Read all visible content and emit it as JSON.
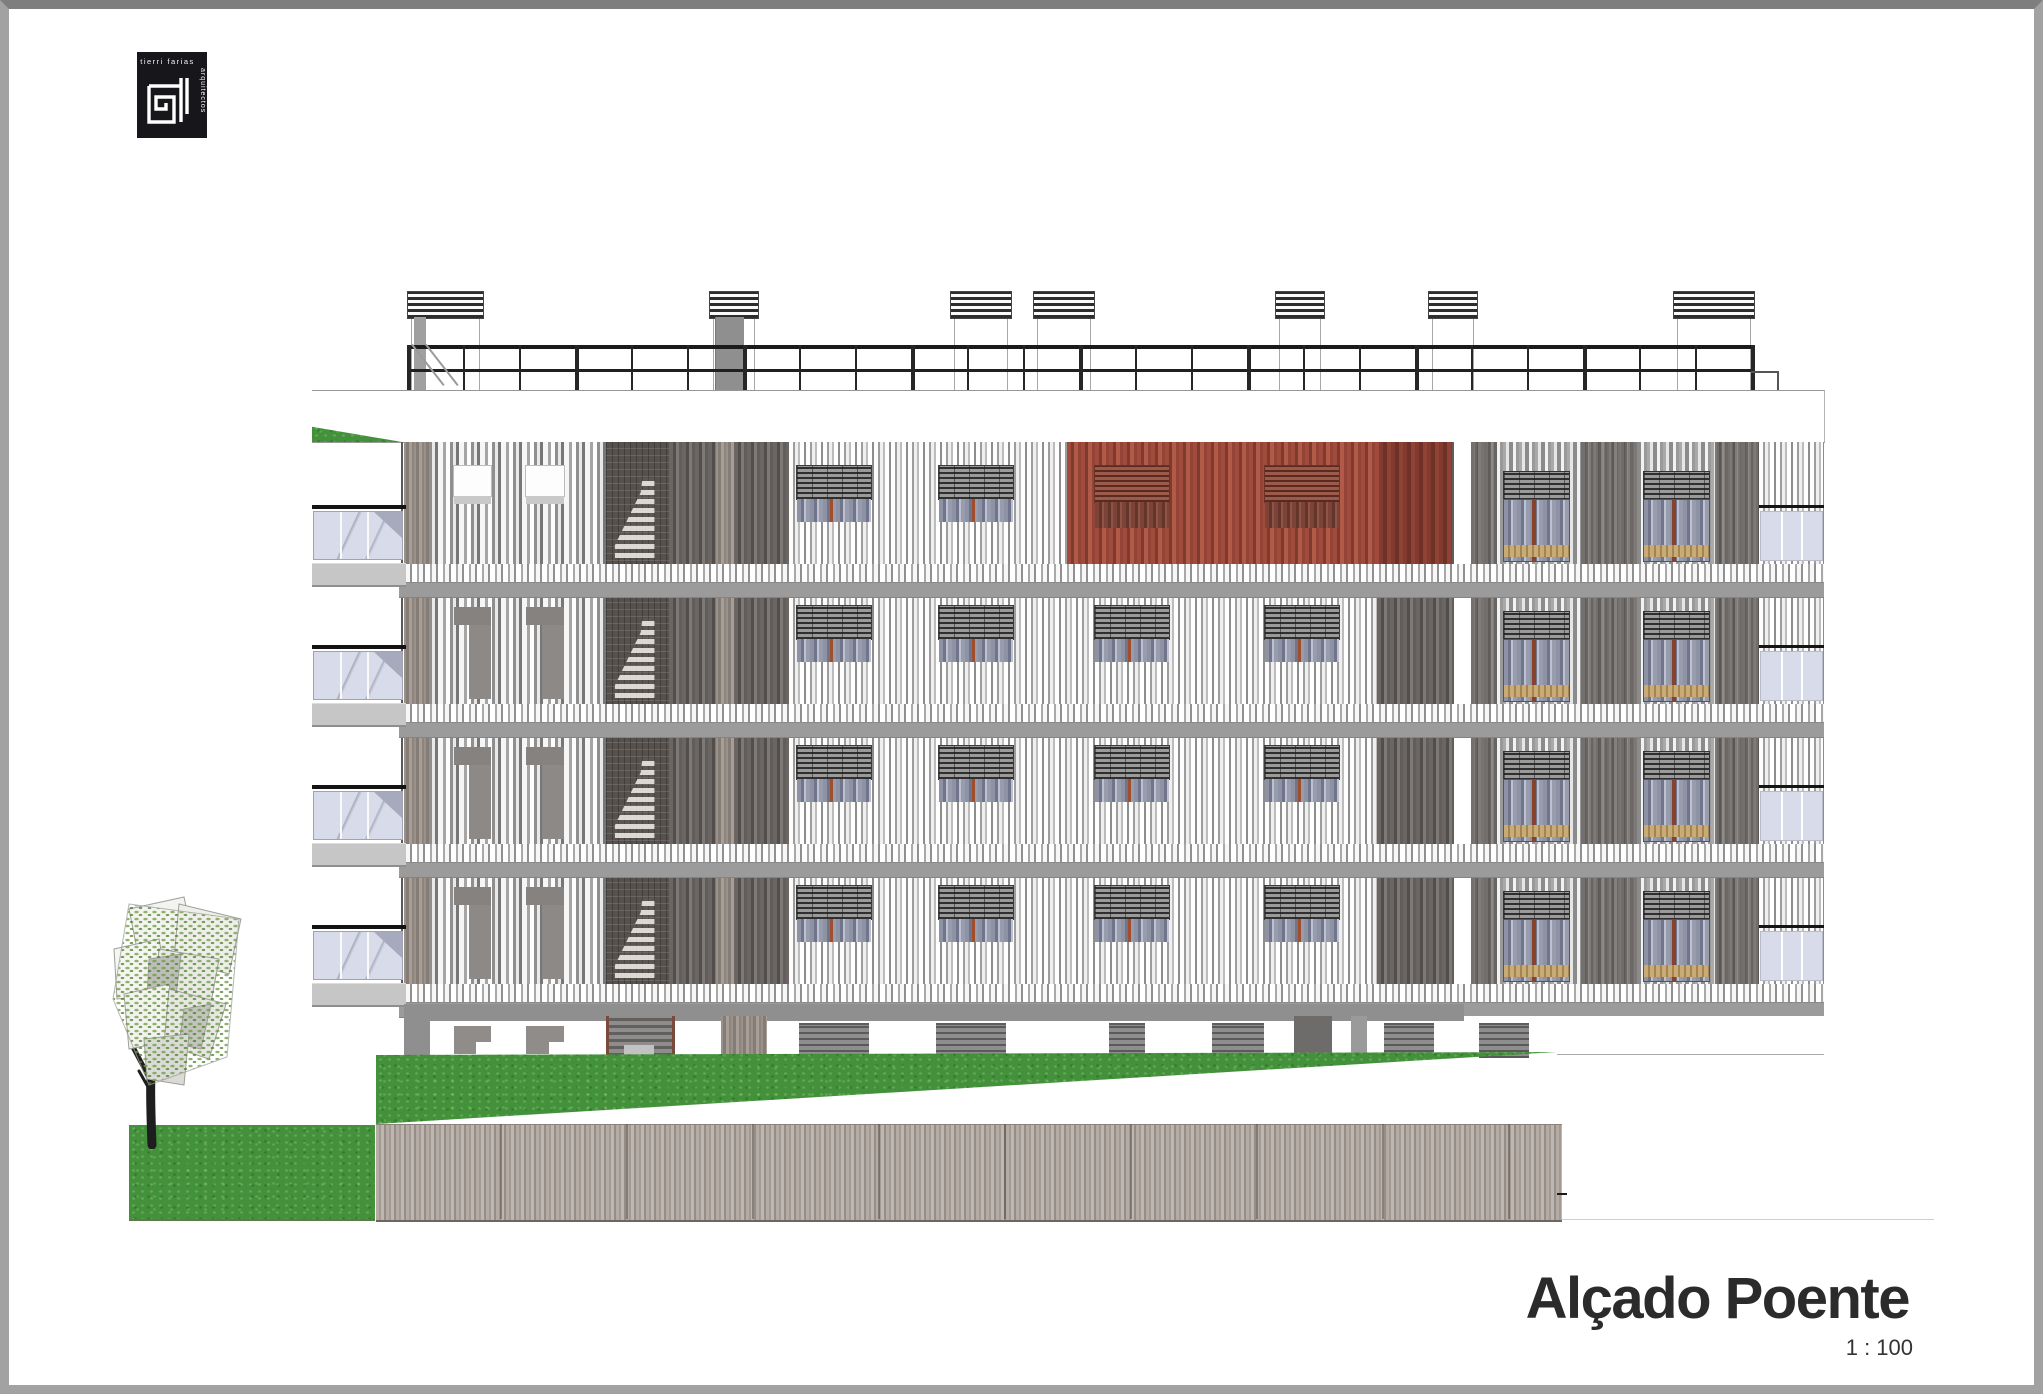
{
  "logo": {
    "line1": "tierri farias",
    "line2": "arquitectos"
  },
  "title": {
    "text": "Alçado Poente",
    "scale": "1 : 100"
  },
  "colors": {
    "accent_red": "#a04b3c",
    "accent_red_dark": "#7f3a2e",
    "grass_green": "#43923b",
    "timber_wall": "#aba29b",
    "slat_dark": "#6b6663",
    "slat_light": "#efefef",
    "balcony_glass": "#d8dbe9",
    "ink": "#1c1c1c",
    "logo_black": "#17171b"
  }
}
